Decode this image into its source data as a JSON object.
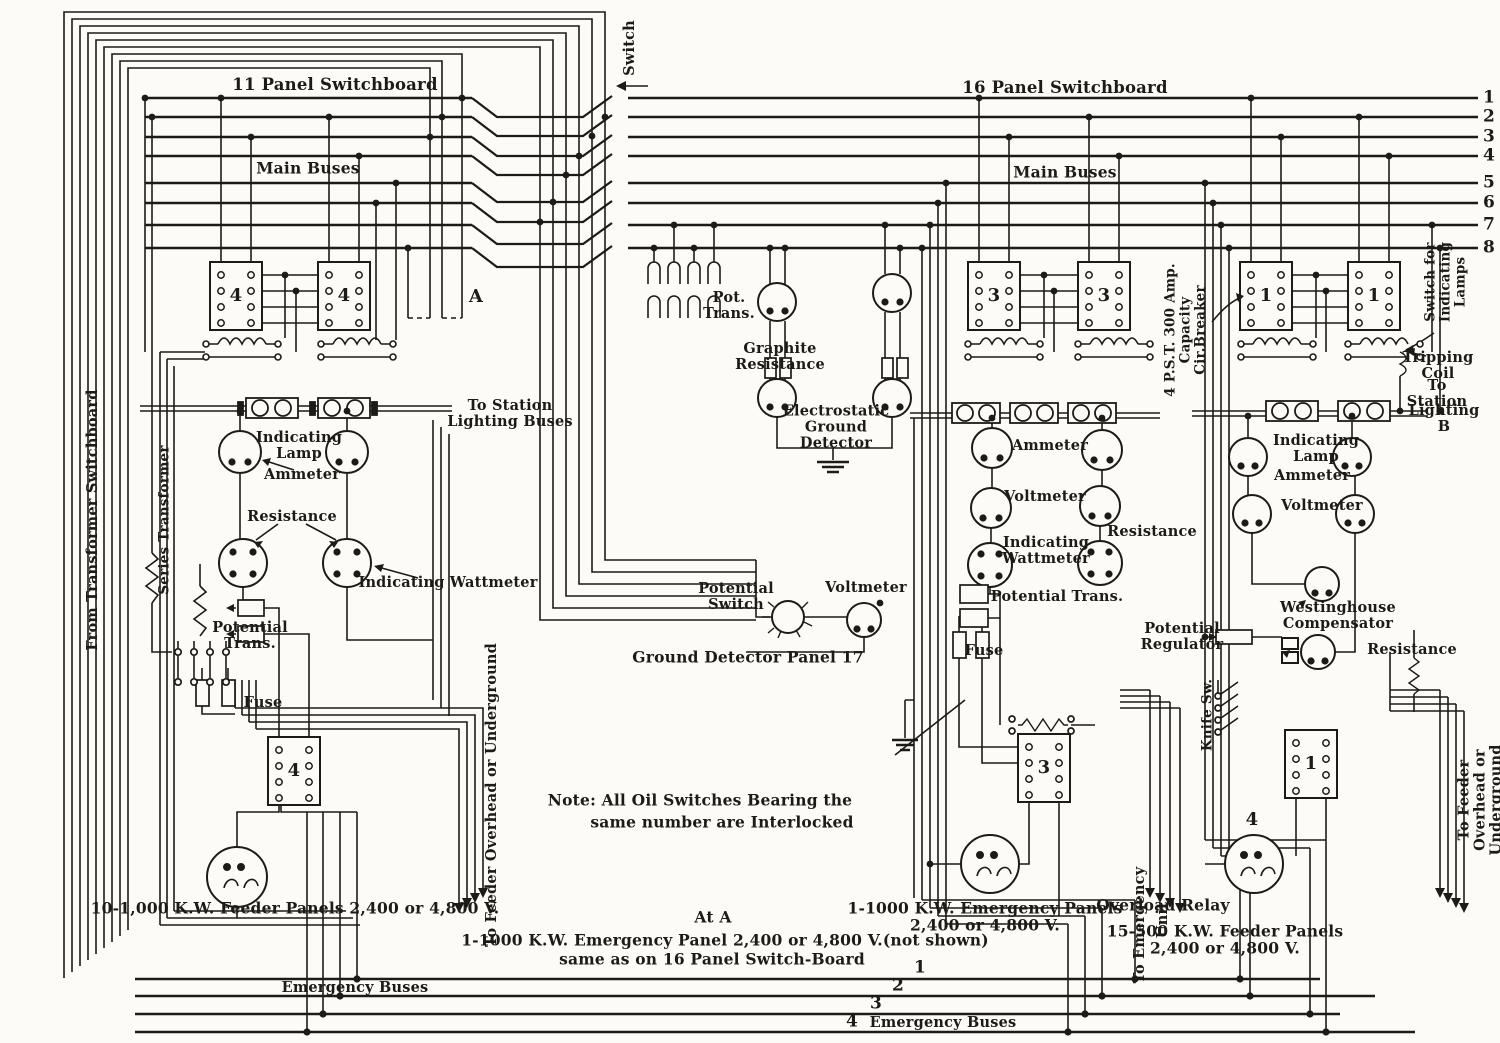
{
  "colors": {
    "ink": "#1d1b16",
    "paper": "#fcfbf7"
  },
  "titles": {
    "left_board": "11 Panel Switchboard",
    "right_board": "16 Panel Switchboard"
  },
  "bus_numbers": [
    "1",
    "2",
    "3",
    "4",
    "5",
    "6",
    "7",
    "8"
  ],
  "emergency_bus_numbers": [
    "1",
    "2",
    "3",
    "4"
  ],
  "oil_switch_numbers": {
    "left_a": "4",
    "left_b": "4",
    "mid_a": "3",
    "mid_b": "3",
    "right_a": "1",
    "right_b": "1",
    "bottom_left": "4",
    "bottom_mid": "3",
    "bottom_right": "1",
    "below_right": "4"
  },
  "markers": {
    "a": "A"
  },
  "labels": {
    "main_buses_left": "Main Buses",
    "main_buses_right": "Main Buses",
    "switch": "Switch",
    "from_transformer_switchboard": "From Transformer Switchboard",
    "series_transformer": "Series Transformer",
    "pot_trans": "Pot.\nTrans.",
    "graphite_resistance": "Graphite\nResistance",
    "electrostatic_ground_detector": "Electrostatic\nGround\nDetector",
    "potential_switch": "Potential\nSwitch",
    "voltmeter_gd": "Voltmeter",
    "ground_detector_panel": "Ground Detector Panel 17",
    "to_station_lighting_buses": "To Station\nLighting Buses",
    "indicating_lamp_left": "Indicating\nLamp",
    "ammeter_left": "Ammeter",
    "resistance_left": "Resistance",
    "indicating_wattmeter_left": "Indicating Wattmeter",
    "potential_trans_left": "Potential\nTrans.",
    "fuse_left": "Fuse",
    "feeder_panels_left": "10-1,000 K.W. Feeder Panels 2,400 or 4,800 V.",
    "to_feeder_left": "To Feeder Overhead or Underground",
    "note_line1": "Note:   All Oil Switches Bearing the",
    "note_line2": "same number are Interlocked",
    "at_a": "At A",
    "at_a_line1": "1-1000 K.W. Emergency Panel 2,400 or 4,800 V.(not shown)",
    "at_a_line2": "same as on 16 Panel  Switch-Board",
    "emergency_buses_left": "Emergency Buses",
    "emergency_buses_right": "Emergency Buses",
    "ammeter_mid": "Ammeter",
    "voltmeter_mid": "Voltmeter",
    "indicating_wattmeter_mid": "Indicating\nWattmeter",
    "resistance_mid": "Resistance",
    "potential_trans_mid": "Potential  Trans.",
    "fuse_mid": "Fuse",
    "potential_regulator": "Potential\nRegulator",
    "emergency_panels_mid": "1-1000 K.W. Emergency Panels\n2,400 or 4,800 V.",
    "to_emergency": "To Emergency",
    "unit": "Unit",
    "circuit_breaker": "4 P.S.T. 300 Amp.\nCapacity\nCir.Breaker",
    "switch_for_lamps": "Switch for\nIndicating Lamps",
    "tripping_coil": "Tripping\nCoil",
    "to_station_right": "To Station",
    "lighting_b": "Lighting B",
    "indicating_lamp_right": "Indicating\nLamp",
    "ammeter_right": "Ammeter",
    "voltmeter_right": "Voltmeter",
    "westinghouse_compensator": "Westinghouse\nCompensator",
    "resistance_right": "Resistance",
    "knife_sw": "Knife Sw.",
    "overload_relay": "Overload Relay",
    "feeder_panels_right": "15-500 K.W. Feeder Panels\n2,400 or 4,800 V.",
    "to_feeder_right": "To Feeder Overhead or Underground"
  }
}
